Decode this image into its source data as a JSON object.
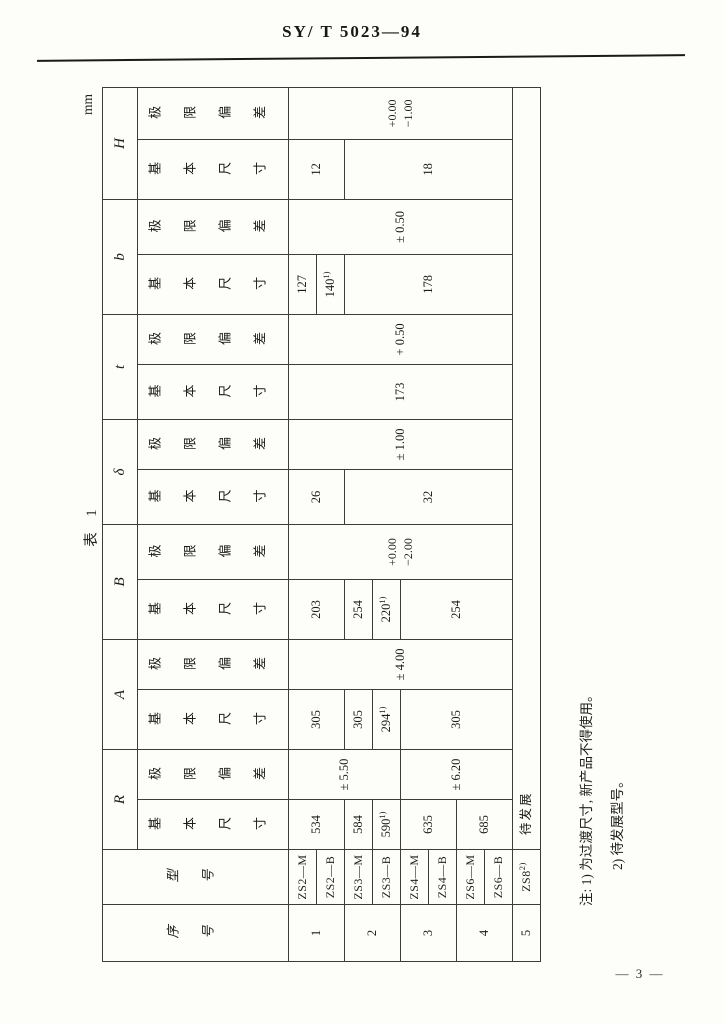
{
  "page": {
    "doc_number": "SY/ T 5023—94",
    "page_number": "— 3 —",
    "unit_label": "mm",
    "table_caption": "表 1"
  },
  "table": {
    "corner": {
      "serial": "序号",
      "model": "型号"
    },
    "letters": [
      "R",
      "A",
      "B",
      "δ",
      "t",
      "b",
      "H"
    ],
    "sub": {
      "basic": "基本尺寸",
      "limit": "极限偏差"
    },
    "serials": [
      "1",
      "2",
      "3",
      "4",
      "5"
    ],
    "models": [
      {
        "v": "ZS2—M"
      },
      {
        "v": "ZS2—B"
      },
      {
        "v": "ZS3—M"
      },
      {
        "v": "ZS3—B"
      },
      {
        "v": "ZS4—M"
      },
      {
        "v": "ZS4—B"
      },
      {
        "v": "ZS6—M"
      },
      {
        "v": "ZS6—B"
      },
      {
        "v": "ZS8",
        "m": "2)"
      }
    ],
    "cells": {
      "R_basic": [
        {
          "v": "534"
        },
        {
          "v": "584"
        },
        {
          "v": "590",
          "m": "1)"
        },
        {
          "v": "635"
        },
        {
          "v": "685"
        }
      ],
      "R_limit": [
        {
          "v": "± 5.50"
        },
        {
          "v": "± 6.20"
        }
      ],
      "A_basic": [
        {
          "v": "305"
        },
        {
          "v": "305"
        },
        {
          "v": "294",
          "m": "1)"
        },
        {
          "v": "305"
        }
      ],
      "A_limit": {
        "v": "± 4.00"
      },
      "B_basic": [
        {
          "v": "203"
        },
        {
          "v": "254"
        },
        {
          "v": "220",
          "m": "1)"
        },
        {
          "v": "254"
        }
      ],
      "B_limit": {
        "top": "+0.00",
        "bottom": "−2.00"
      },
      "delta_basic": [
        {
          "v": "26"
        },
        {
          "v": "32"
        }
      ],
      "delta_limit": {
        "v": "± 1.00"
      },
      "t_basic": {
        "v": "173"
      },
      "t_limit": {
        "v": "+ 0.50"
      },
      "b_basic": [
        {
          "v": "127"
        },
        {
          "v": "140",
          "m": "1)"
        },
        {
          "v": "178"
        }
      ],
      "b_limit": {
        "v": "± 0.50"
      },
      "H_basic": [
        {
          "v": "12"
        },
        {
          "v": "18"
        }
      ],
      "H_limit": {
        "top": "+0.00",
        "bottom": "−1.00"
      },
      "pending": "待发展"
    }
  },
  "notes": {
    "line1": "注: 1) 为过渡尺寸, 新产品不得使用。",
    "line2": "2) 待发展型号。"
  }
}
